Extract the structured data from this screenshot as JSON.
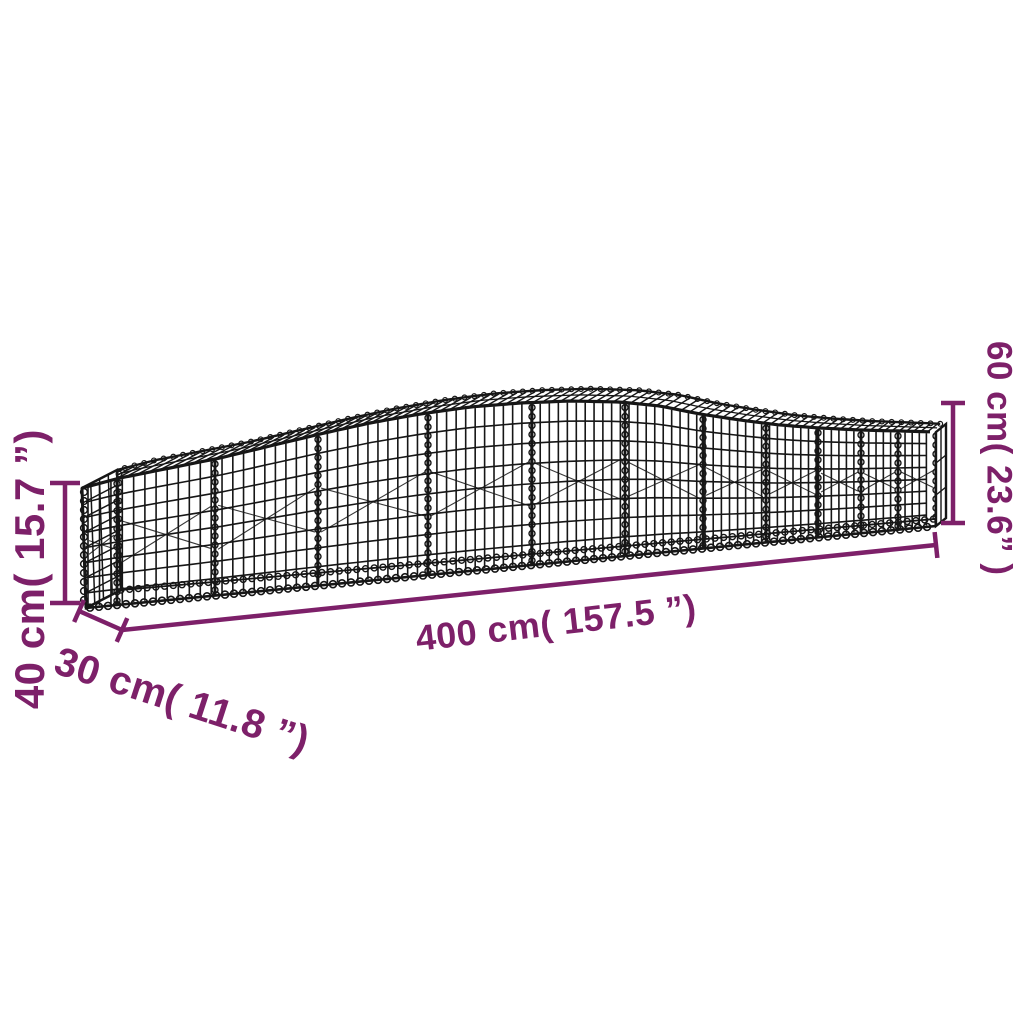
{
  "figure": {
    "title": "Arched gabion basket dimension diagram",
    "illustration": "arched-gabion-wire-mesh-basket",
    "background_color": "#ffffff",
    "wire_color": "#161616",
    "dimension_color": "#7D2069",
    "dimensions": {
      "length": {
        "label": "400 cm( 157.5 ”)",
        "cm": 400,
        "inches": 157.5
      },
      "depth": {
        "label": "30 cm( 11.8 ”)",
        "cm": 30,
        "inches": 11.8
      },
      "height_left": {
        "label": "40 cm( 15.7 ”)",
        "cm": 40,
        "inches": 15.7
      },
      "height_right": {
        "label": "60 cm( 23.6” )",
        "cm": 60,
        "inches": 23.6
      }
    }
  }
}
